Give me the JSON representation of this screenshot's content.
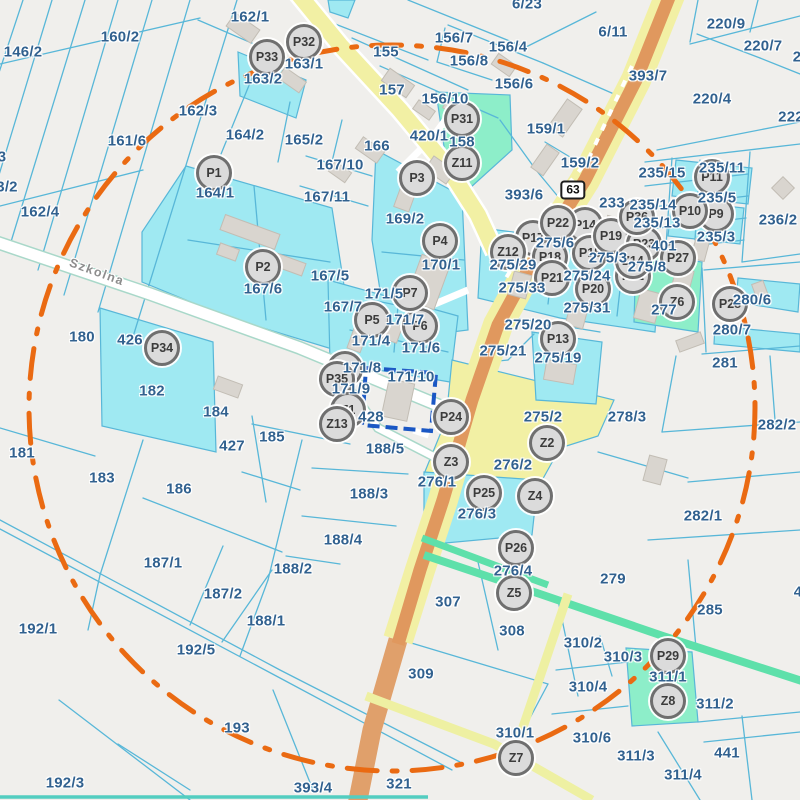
{
  "map": {
    "street": {
      "name": "Szkolna",
      "x": 97,
      "y": 272,
      "angle": 20
    },
    "route_shield": {
      "number": "63",
      "x": 573,
      "y": 190
    },
    "selected_parcel": "171/10",
    "colors": {
      "background": "#f0efec",
      "parcel_line": "#58b7d8",
      "label_text": "#31618f",
      "street_text": "#8d8d8d",
      "cyan_parcel": "#9fe9f2",
      "mint_parcel": "#8deec9",
      "mint_road": "#5ee0aa",
      "yellow_parcel": "#f2f0a4",
      "road_core": "#e0985e",
      "ring_orange": "#ea6a12",
      "selection_blue": "#1a57c4",
      "marker_bg": "#dbdbdb",
      "marker_border": "#6f6f6f"
    },
    "parcel_labels": [
      {
        "t": "146/2",
        "x": 23,
        "y": 52
      },
      {
        "t": "160/2",
        "x": 120,
        "y": 37
      },
      {
        "t": "162/1",
        "x": 250,
        "y": 17
      },
      {
        "t": "163/2",
        "x": 263,
        "y": 79
      },
      {
        "t": "163/1",
        "x": 304,
        "y": 64
      },
      {
        "t": "162/3",
        "x": 198,
        "y": 111
      },
      {
        "t": "161/6",
        "x": 127,
        "y": 141
      },
      {
        "t": "164/2",
        "x": 245,
        "y": 135
      },
      {
        "t": "162/4",
        "x": 40,
        "y": 212
      },
      {
        "t": "3",
        "x": 2,
        "y": 157
      },
      {
        "t": "3/2",
        "x": 7,
        "y": 187
      },
      {
        "t": "164/1",
        "x": 215,
        "y": 193
      },
      {
        "t": "165/2",
        "x": 304,
        "y": 140
      },
      {
        "t": "155",
        "x": 386,
        "y": 52
      },
      {
        "t": "156/7",
        "x": 454,
        "y": 38
      },
      {
        "t": "156/8",
        "x": 469,
        "y": 61
      },
      {
        "t": "156/4",
        "x": 508,
        "y": 47
      },
      {
        "t": "156/6",
        "x": 514,
        "y": 84
      },
      {
        "t": "157",
        "x": 392,
        "y": 90
      },
      {
        "t": "156/10",
        "x": 445,
        "y": 99
      },
      {
        "t": "420/1",
        "x": 429,
        "y": 136
      },
      {
        "t": "158",
        "x": 462,
        "y": 142
      },
      {
        "t": "159/1",
        "x": 546,
        "y": 129
      },
      {
        "t": "159/2",
        "x": 580,
        "y": 163
      },
      {
        "t": "6/23",
        "x": 527,
        "y": 4
      },
      {
        "t": "6/11",
        "x": 613,
        "y": 32
      },
      {
        "t": "393/7",
        "x": 648,
        "y": 76
      },
      {
        "t": "220/9",
        "x": 726,
        "y": 24
      },
      {
        "t": "220/7",
        "x": 763,
        "y": 46
      },
      {
        "t": "220/4",
        "x": 712,
        "y": 99
      },
      {
        "t": "2",
        "x": 797,
        "y": 57
      },
      {
        "t": "222",
        "x": 791,
        "y": 117
      },
      {
        "t": "166",
        "x": 377,
        "y": 146
      },
      {
        "t": "167/10",
        "x": 340,
        "y": 165
      },
      {
        "t": "167/11",
        "x": 327,
        "y": 197
      },
      {
        "t": "169/2",
        "x": 405,
        "y": 219
      },
      {
        "t": "393/6",
        "x": 524,
        "y": 195
      },
      {
        "t": "233",
        "x": 612,
        "y": 203
      },
      {
        "t": "235/15",
        "x": 662,
        "y": 173
      },
      {
        "t": "235/11",
        "x": 722,
        "y": 168
      },
      {
        "t": "235/5",
        "x": 717,
        "y": 198
      },
      {
        "t": "235/14",
        "x": 653,
        "y": 205
      },
      {
        "t": "235/13",
        "x": 657,
        "y": 223
      },
      {
        "t": "235/3",
        "x": 716,
        "y": 237
      },
      {
        "t": "236/2",
        "x": 778,
        "y": 220
      },
      {
        "t": "401",
        "x": 664,
        "y": 246
      },
      {
        "t": "275/6",
        "x": 555,
        "y": 243
      },
      {
        "t": "275/29",
        "x": 513,
        "y": 265
      },
      {
        "t": "275/33",
        "x": 522,
        "y": 288
      },
      {
        "t": "275/24",
        "x": 587,
        "y": 276
      },
      {
        "t": "275/31",
        "x": 587,
        "y": 308
      },
      {
        "t": "275/3",
        "x": 608,
        "y": 258
      },
      {
        "t": "275/8",
        "x": 647,
        "y": 267
      },
      {
        "t": "275/20",
        "x": 528,
        "y": 325
      },
      {
        "t": "275/21",
        "x": 503,
        "y": 351
      },
      {
        "t": "275/19",
        "x": 558,
        "y": 358
      },
      {
        "t": "277",
        "x": 664,
        "y": 310
      },
      {
        "t": "280/6",
        "x": 752,
        "y": 300
      },
      {
        "t": "280/7",
        "x": 732,
        "y": 330
      },
      {
        "t": "281",
        "x": 725,
        "y": 363
      },
      {
        "t": "282/2",
        "x": 777,
        "y": 425
      },
      {
        "t": "282/1",
        "x": 703,
        "y": 516
      },
      {
        "t": "278/3",
        "x": 627,
        "y": 417
      },
      {
        "t": "275/2",
        "x": 543,
        "y": 417
      },
      {
        "t": "276/2",
        "x": 513,
        "y": 465
      },
      {
        "t": "276/1",
        "x": 437,
        "y": 482
      },
      {
        "t": "276/3",
        "x": 477,
        "y": 514
      },
      {
        "t": "276/4",
        "x": 513,
        "y": 571
      },
      {
        "t": "307",
        "x": 448,
        "y": 602
      },
      {
        "t": "308",
        "x": 512,
        "y": 631
      },
      {
        "t": "309",
        "x": 421,
        "y": 674
      },
      {
        "t": "310/2",
        "x": 583,
        "y": 643
      },
      {
        "t": "310/3",
        "x": 623,
        "y": 657
      },
      {
        "t": "310/4",
        "x": 588,
        "y": 687
      },
      {
        "t": "310/6",
        "x": 592,
        "y": 738
      },
      {
        "t": "310/1",
        "x": 515,
        "y": 733
      },
      {
        "t": "311/1",
        "x": 668,
        "y": 677
      },
      {
        "t": "311/2",
        "x": 715,
        "y": 704
      },
      {
        "t": "311/3",
        "x": 636,
        "y": 756
      },
      {
        "t": "311/4",
        "x": 683,
        "y": 775
      },
      {
        "t": "441",
        "x": 727,
        "y": 753
      },
      {
        "t": "4",
        "x": 798,
        "y": 592
      },
      {
        "t": "279",
        "x": 613,
        "y": 579
      },
      {
        "t": "285",
        "x": 710,
        "y": 610
      },
      {
        "t": "321",
        "x": 399,
        "y": 784
      },
      {
        "t": "393/4",
        "x": 313,
        "y": 788
      },
      {
        "t": "193",
        "x": 237,
        "y": 728
      },
      {
        "t": "192/5",
        "x": 196,
        "y": 650
      },
      {
        "t": "192/1",
        "x": 38,
        "y": 629
      },
      {
        "t": "192/3",
        "x": 65,
        "y": 783
      },
      {
        "t": "188/1",
        "x": 266,
        "y": 621
      },
      {
        "t": "187/2",
        "x": 223,
        "y": 594
      },
      {
        "t": "187/1",
        "x": 163,
        "y": 563
      },
      {
        "t": "188/2",
        "x": 293,
        "y": 569
      },
      {
        "t": "188/4",
        "x": 343,
        "y": 540
      },
      {
        "t": "188/3",
        "x": 369,
        "y": 494
      },
      {
        "t": "188/5",
        "x": 385,
        "y": 449
      },
      {
        "t": "186",
        "x": 179,
        "y": 489
      },
      {
        "t": "183",
        "x": 102,
        "y": 478
      },
      {
        "t": "181",
        "x": 22,
        "y": 453
      },
      {
        "t": "185",
        "x": 272,
        "y": 437
      },
      {
        "t": "427",
        "x": 232,
        "y": 446
      },
      {
        "t": "184",
        "x": 216,
        "y": 412
      },
      {
        "t": "182",
        "x": 152,
        "y": 391
      },
      {
        "t": "426",
        "x": 130,
        "y": 340
      },
      {
        "t": "180",
        "x": 82,
        "y": 337
      },
      {
        "t": "428",
        "x": 371,
        "y": 417
      },
      {
        "t": "171/10",
        "x": 411,
        "y": 377
      },
      {
        "t": "171/8",
        "x": 362,
        "y": 368
      },
      {
        "t": "171/9",
        "x": 351,
        "y": 389
      },
      {
        "t": "171/4",
        "x": 371,
        "y": 341
      },
      {
        "t": "171/7",
        "x": 405,
        "y": 320
      },
      {
        "t": "171/6",
        "x": 421,
        "y": 348
      },
      {
        "t": "171/5",
        "x": 384,
        "y": 294
      },
      {
        "t": "167/7",
        "x": 343,
        "y": 307
      },
      {
        "t": "167/5",
        "x": 330,
        "y": 276
      },
      {
        "t": "167/6",
        "x": 263,
        "y": 289
      },
      {
        "t": "170/1",
        "x": 441,
        "y": 265
      }
    ],
    "markers": [
      {
        "id": "P1",
        "x": 214,
        "y": 173
      },
      {
        "id": "P2",
        "x": 263,
        "y": 267
      },
      {
        "id": "P3",
        "x": 417,
        "y": 178
      },
      {
        "id": "P4",
        "x": 440,
        "y": 241
      },
      {
        "id": "P5",
        "x": 372,
        "y": 320
      },
      {
        "id": "P6",
        "x": 420,
        "y": 326
      },
      {
        "id": "P7",
        "x": 410,
        "y": 293
      },
      {
        "id": "P8",
        "x": 345,
        "y": 369
      },
      {
        "id": "P9",
        "x": 716,
        "y": 214
      },
      {
        "id": "P10",
        "x": 690,
        "y": 211
      },
      {
        "id": "P11",
        "x": 712,
        "y": 177
      },
      {
        "id": "P12",
        "x": 633,
        "y": 276
      },
      {
        "id": "P13",
        "x": 558,
        "y": 339
      },
      {
        "id": "P14",
        "x": 585,
        "y": 225
      },
      {
        "id": "P15",
        "x": 590,
        "y": 253
      },
      {
        "id": "P17",
        "x": 533,
        "y": 238
      },
      {
        "id": "P18",
        "x": 550,
        "y": 257
      },
      {
        "id": "P19",
        "x": 611,
        "y": 236
      },
      {
        "id": "P20",
        "x": 593,
        "y": 289
      },
      {
        "id": "P21",
        "x": 552,
        "y": 278
      },
      {
        "id": "P22",
        "x": 558,
        "y": 223
      },
      {
        "id": "P23",
        "x": 644,
        "y": 244
      },
      {
        "id": "P24",
        "x": 451,
        "y": 417
      },
      {
        "id": "P25",
        "x": 484,
        "y": 493
      },
      {
        "id": "P26",
        "x": 516,
        "y": 548
      },
      {
        "id": "P27",
        "x": 678,
        "y": 258
      },
      {
        "id": "P28",
        "x": 730,
        "y": 304
      },
      {
        "id": "P29",
        "x": 668,
        "y": 656
      },
      {
        "id": "P31",
        "x": 462,
        "y": 119
      },
      {
        "id": "P32",
        "x": 304,
        "y": 42
      },
      {
        "id": "P33",
        "x": 267,
        "y": 57
      },
      {
        "id": "P34",
        "x": 162,
        "y": 348
      },
      {
        "id": "P35",
        "x": 337,
        "y": 379
      },
      {
        "id": "P36",
        "x": 637,
        "y": 217
      },
      {
        "id": "Z1",
        "x": 348,
        "y": 410
      },
      {
        "id": "Z2",
        "x": 547,
        "y": 443
      },
      {
        "id": "Z3",
        "x": 451,
        "y": 462
      },
      {
        "id": "Z4",
        "x": 535,
        "y": 496
      },
      {
        "id": "Z5",
        "x": 514,
        "y": 593
      },
      {
        "id": "Z6",
        "x": 677,
        "y": 302
      },
      {
        "id": "Z7",
        "x": 516,
        "y": 758
      },
      {
        "id": "Z8",
        "x": 668,
        "y": 701
      },
      {
        "id": "Z11",
        "x": 462,
        "y": 163
      },
      {
        "id": "Z12",
        "x": 508,
        "y": 252
      },
      {
        "id": "Z13",
        "x": 337,
        "y": 424
      },
      {
        "id": "Z14",
        "x": 633,
        "y": 261
      }
    ]
  }
}
